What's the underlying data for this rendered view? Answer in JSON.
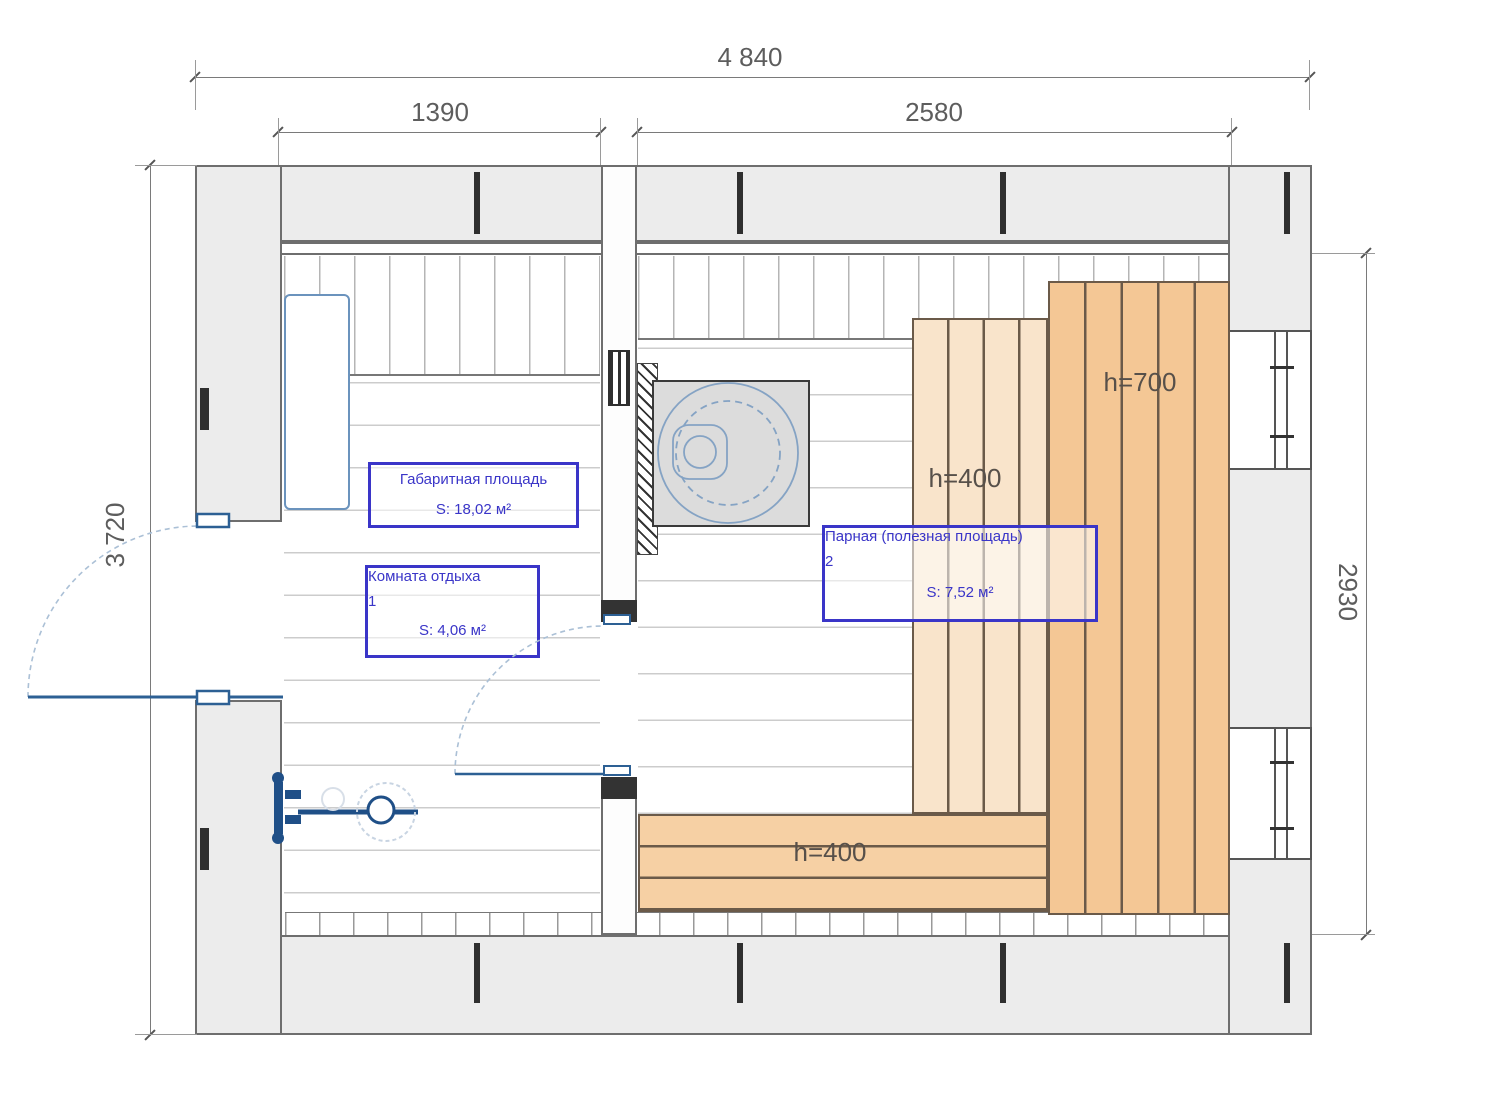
{
  "dims": {
    "overall_width": "4 840",
    "left_room_width": "1390",
    "right_room_width": "2580",
    "overall_depth": "3 720",
    "inner_depth": "2930"
  },
  "areas": {
    "overall": {
      "title": "Габаритная площадь",
      "value": "S: 18,02 м²"
    },
    "room1": {
      "name": "Комната отдыха",
      "number": "1",
      "value": "S: 4,06 м²"
    },
    "room2": {
      "name": "Парная (полезная площадь)",
      "number": "2",
      "value": "S: 7,52 м²"
    }
  },
  "benches": {
    "tall_height": "h=700",
    "mid_height": "h=400",
    "bottom_height": "h=400"
  },
  "colors": {
    "annotation_blue": "#3a35c8",
    "fixture_blue": "#2d6094",
    "door_arc_blue": "#abc0d6",
    "bench_dark": "#f4c795",
    "bench_light": "#f9e4cb",
    "bench_bottom": "#f6d0a4",
    "wood_line": "#6b5a49",
    "wall_fill": "#ececec",
    "wall_line": "#6e6e6e"
  }
}
